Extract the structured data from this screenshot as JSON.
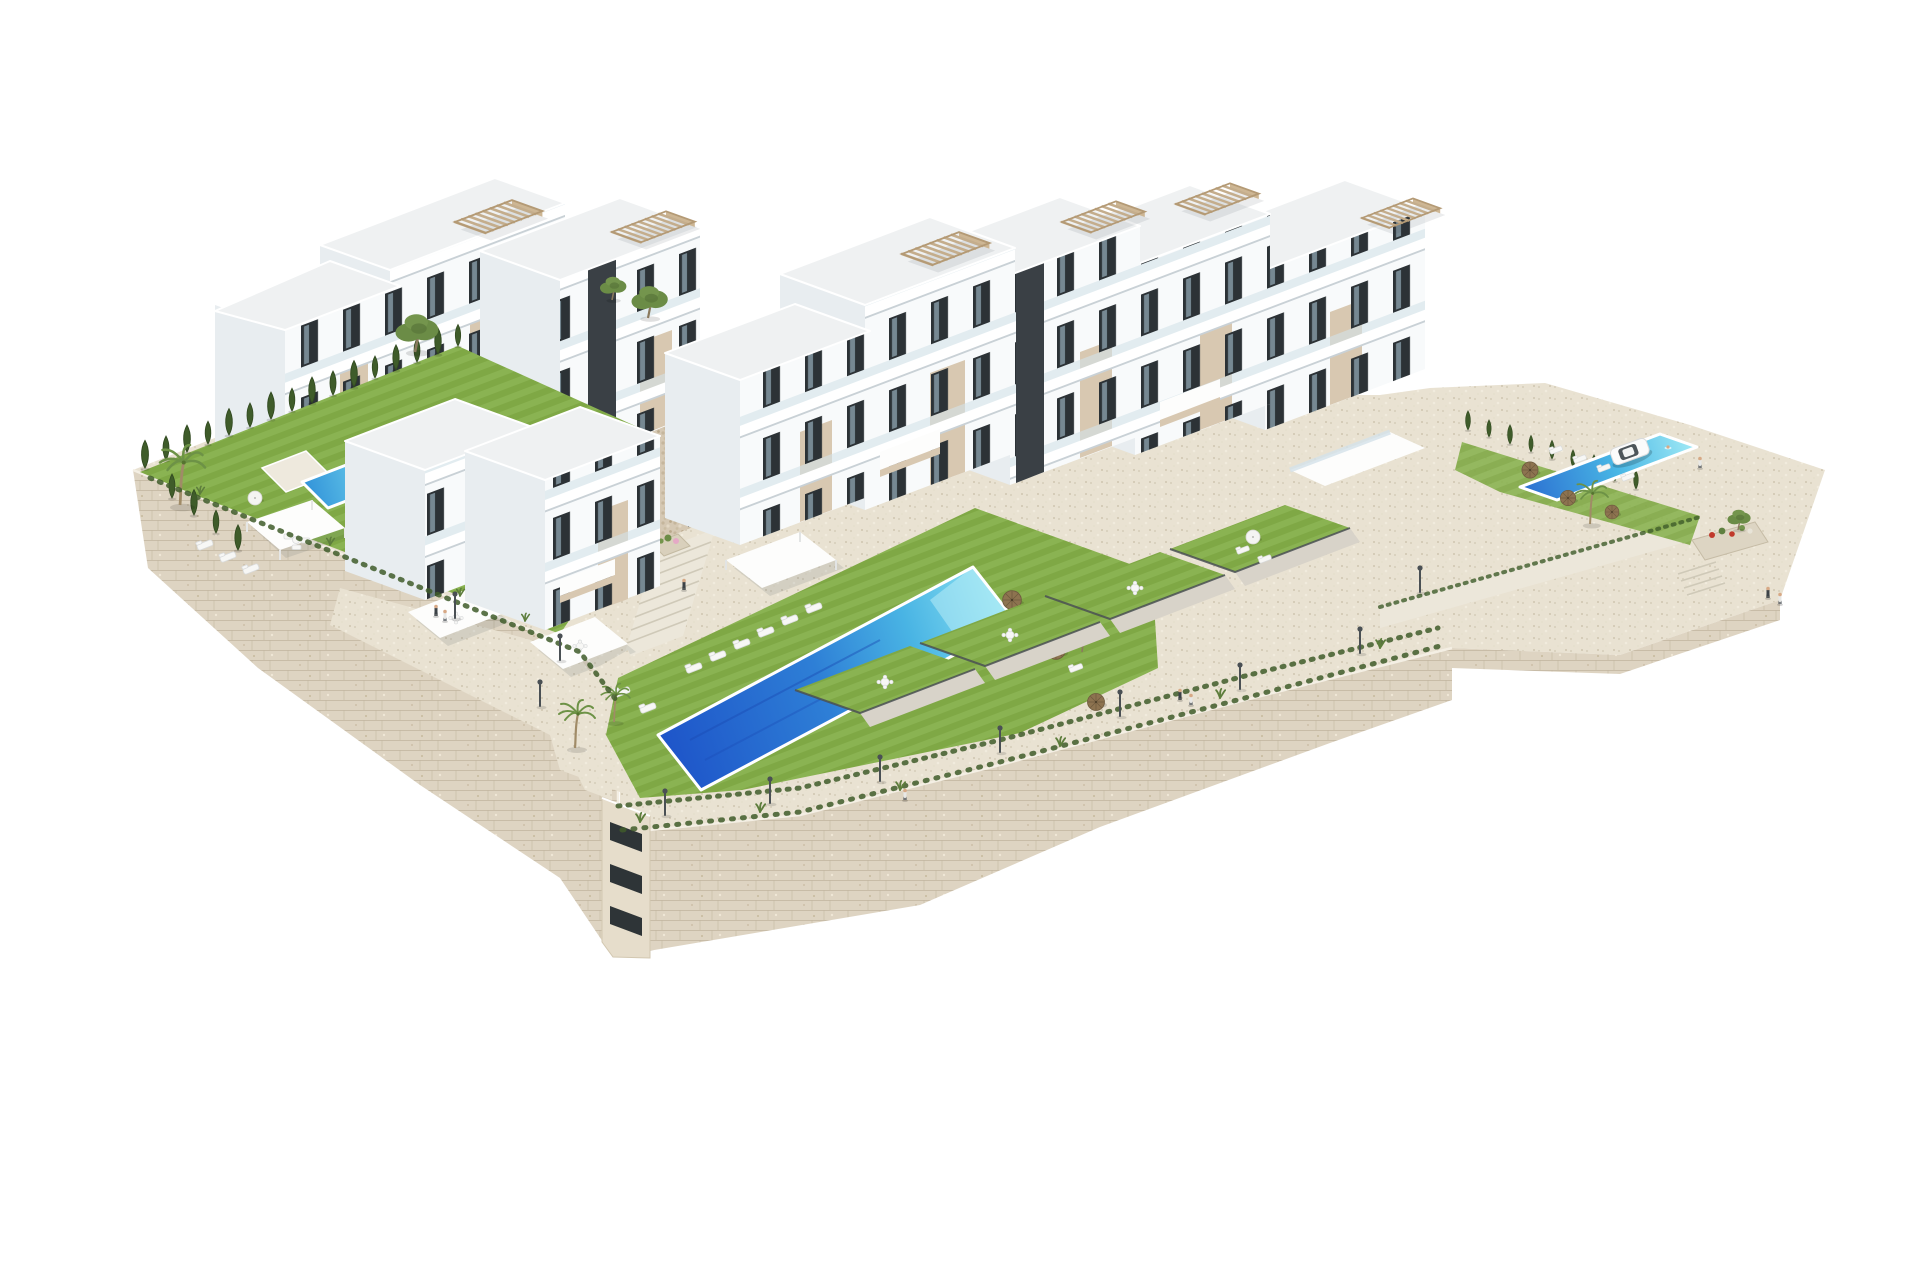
{
  "meta": {
    "title": "Aerial 3D architectural rendering of a hillside apartment complex",
    "description": "Isometric-style aerial render on a plain white background: stepped white modern apartment blocks with beige accent panels, dark elevator cores, glass balcony terraces and rooftop pergolas; landscaped lawns, cypress hedges, palm trees; a large central turquoise pool with sun loungers and straw umbrellas, a small private villa pool on the west garden and a rectangular pool on the east terrace next to a parked white SUV; beige dry-stone retaining walls with a lamp-lined promenade and tiny human figures."
  },
  "palette": {
    "background": "#ffffff",
    "facade_white": "#f8fafb",
    "facade_shade": "#e8edf0",
    "roof_light": "#eff1f2",
    "accent_beige": "#d8c8b1",
    "window_dark": "#2c3236",
    "core_dark": "#3a4045",
    "pergola_tan": "#c4ad8c",
    "stone_wall": "#ded4c2",
    "stone_joint": "#c3b7a0",
    "paving": "#e9e2d2",
    "lawn_green": "#7fa845",
    "lawn_light": "#8ab352",
    "hedge_green": "#3f5c2a",
    "pool_deep": "#1e55c9",
    "pool_light": "#62cdea",
    "umbrella_straw": "#8d7350",
    "metal_gray": "#4a5054",
    "people_dark": "#3c4247",
    "flower_pink": "#e5a9c6"
  },
  "scene": {
    "buildings": {
      "blocks": 9,
      "stories_max": 4,
      "features": [
        "white facades",
        "beige accent panels",
        "dark elevator cores",
        "glass balcony terraces",
        "rooftop slat pergolas",
        "floor-to-ceiling windows"
      ]
    },
    "pools": [
      {
        "id": "main-pool",
        "location": "central lower terrace",
        "shape": "elongated parallelogram",
        "water": [
          "deep blue",
          "turquoise"
        ],
        "loungers": 8,
        "straw_umbrellas": 3,
        "swimmers": 2
      },
      {
        "id": "villa-pool",
        "location": "west private garden",
        "shape": "small rectangle",
        "loungers": 3,
        "white_parasols": 1
      },
      {
        "id": "east-pool",
        "location": "east upper terrace",
        "shape": "rectangle",
        "loungers": 4,
        "straw_umbrellas": 3,
        "palm_trees": 1
      }
    ],
    "landscape": {
      "private_lawn_terraces": 5,
      "cypress_hedges": 2,
      "palm_trees": 4,
      "olive_trees": 4,
      "flower_planters": 2,
      "grass_fringe": "along retaining wall tops"
    },
    "hardscape": {
      "retaining_walls": "beige dry-stack stone masonry",
      "promenade": "pebbled walkway with street lamps",
      "stair_flights": 2,
      "street_lamps": 11,
      "entrance_pavilion": "stone-mosaic clad block with dark glass door"
    },
    "figures": {
      "people_groups": 6,
      "swimmers": 2
    },
    "vehicle": {
      "type": "white SUV",
      "location": "east terrace parking"
    }
  }
}
